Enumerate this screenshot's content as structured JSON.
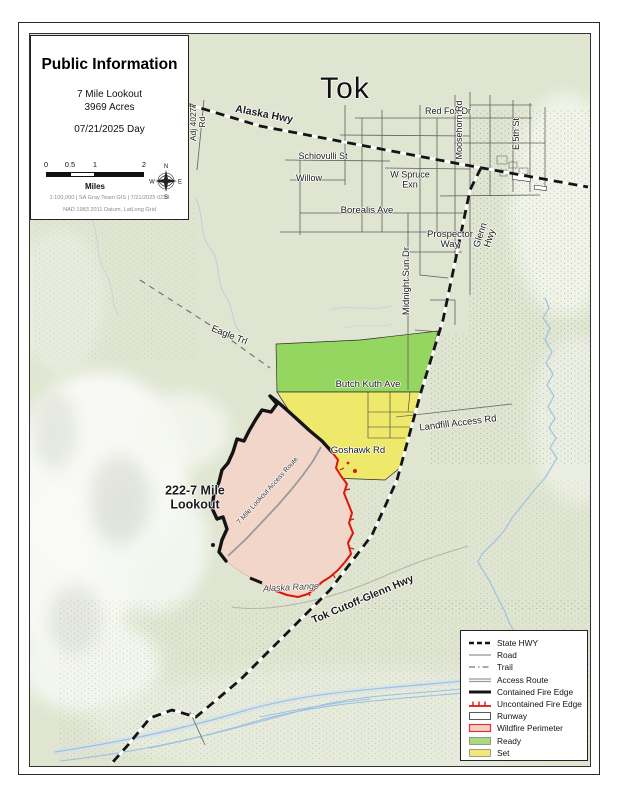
{
  "title_box": {
    "title": "Public Information",
    "fire_name": "7 Mile Lookout",
    "acres": "3969 Acres",
    "date": "07/21/2025 Day",
    "scale_ticks": [
      "0",
      "0.5",
      "1",
      "2"
    ],
    "scale_unit": "Miles",
    "credits_line1": "1:100,000 |  SA Gray Team GIS | 7/21/2025 0234",
    "credits_line2": "NAD 1983 2011 Datum, LatLong Grid",
    "compass": {
      "n": "N",
      "e": "E",
      "s": "S",
      "w": "W"
    }
  },
  "map_labels": {
    "town": "Tok",
    "alaska_hwy": "Alaska Hwy",
    "adj_rd": "Adj 40277 Rd",
    "red_fox": "Red Fox Dr",
    "moosehorn": "Moosehorn Rd",
    "e5th": "E 5th St",
    "schiovulli": "Schiovulli St",
    "willow": "Willow",
    "w_spruce": "W Spruce Exn",
    "borealis": "Borealis Ave",
    "prospector": "Prospector Way",
    "midnight_sun": "Midnight Sun Dr",
    "glenn_hwy": "Glenn Hwy",
    "eagle_trl": "Eagle Trl",
    "butch_kuth": "Butch Kuth Ave",
    "landfill": "Landfill Access Rd",
    "goshawk": "Goshawk Rd",
    "fire_label": "222-7 Mile Lookout",
    "access_route": "7 Mile Lookout Access Route",
    "alaska_range": "Alaska Range",
    "tok_cutoff": "Tok Cutoff-Glenn Hwy"
  },
  "legend": {
    "items": [
      {
        "label": "State HWY",
        "symbol": "state-hwy-line"
      },
      {
        "label": "Road",
        "symbol": "road-line"
      },
      {
        "label": "Trail",
        "symbol": "trail-line"
      },
      {
        "label": "Access Route",
        "symbol": "access-route-line"
      },
      {
        "label": "Contained Fire Edge",
        "symbol": "contained-fire-edge-line"
      },
      {
        "label": "Uncontained Fire Edge",
        "symbol": "uncontained-fire-edge-line"
      },
      {
        "label": "Runway",
        "symbol": "runway-swatch"
      },
      {
        "label": "Wildfire Perimeter",
        "symbol": "wildfire-perimeter-swatch"
      },
      {
        "label": "Ready",
        "symbol": "ready-swatch"
      },
      {
        "label": "Set",
        "symbol": "set-swatch"
      }
    ]
  },
  "colors": {
    "map_background": "#dfe5d0",
    "ready_green": "#95d661",
    "set_yellow": "#eee96b",
    "perimeter_pink": "#f2d6ca",
    "uncontained_red": "#de1508",
    "contained_black": "#141414",
    "water_blue": "#9cc0e2"
  }
}
